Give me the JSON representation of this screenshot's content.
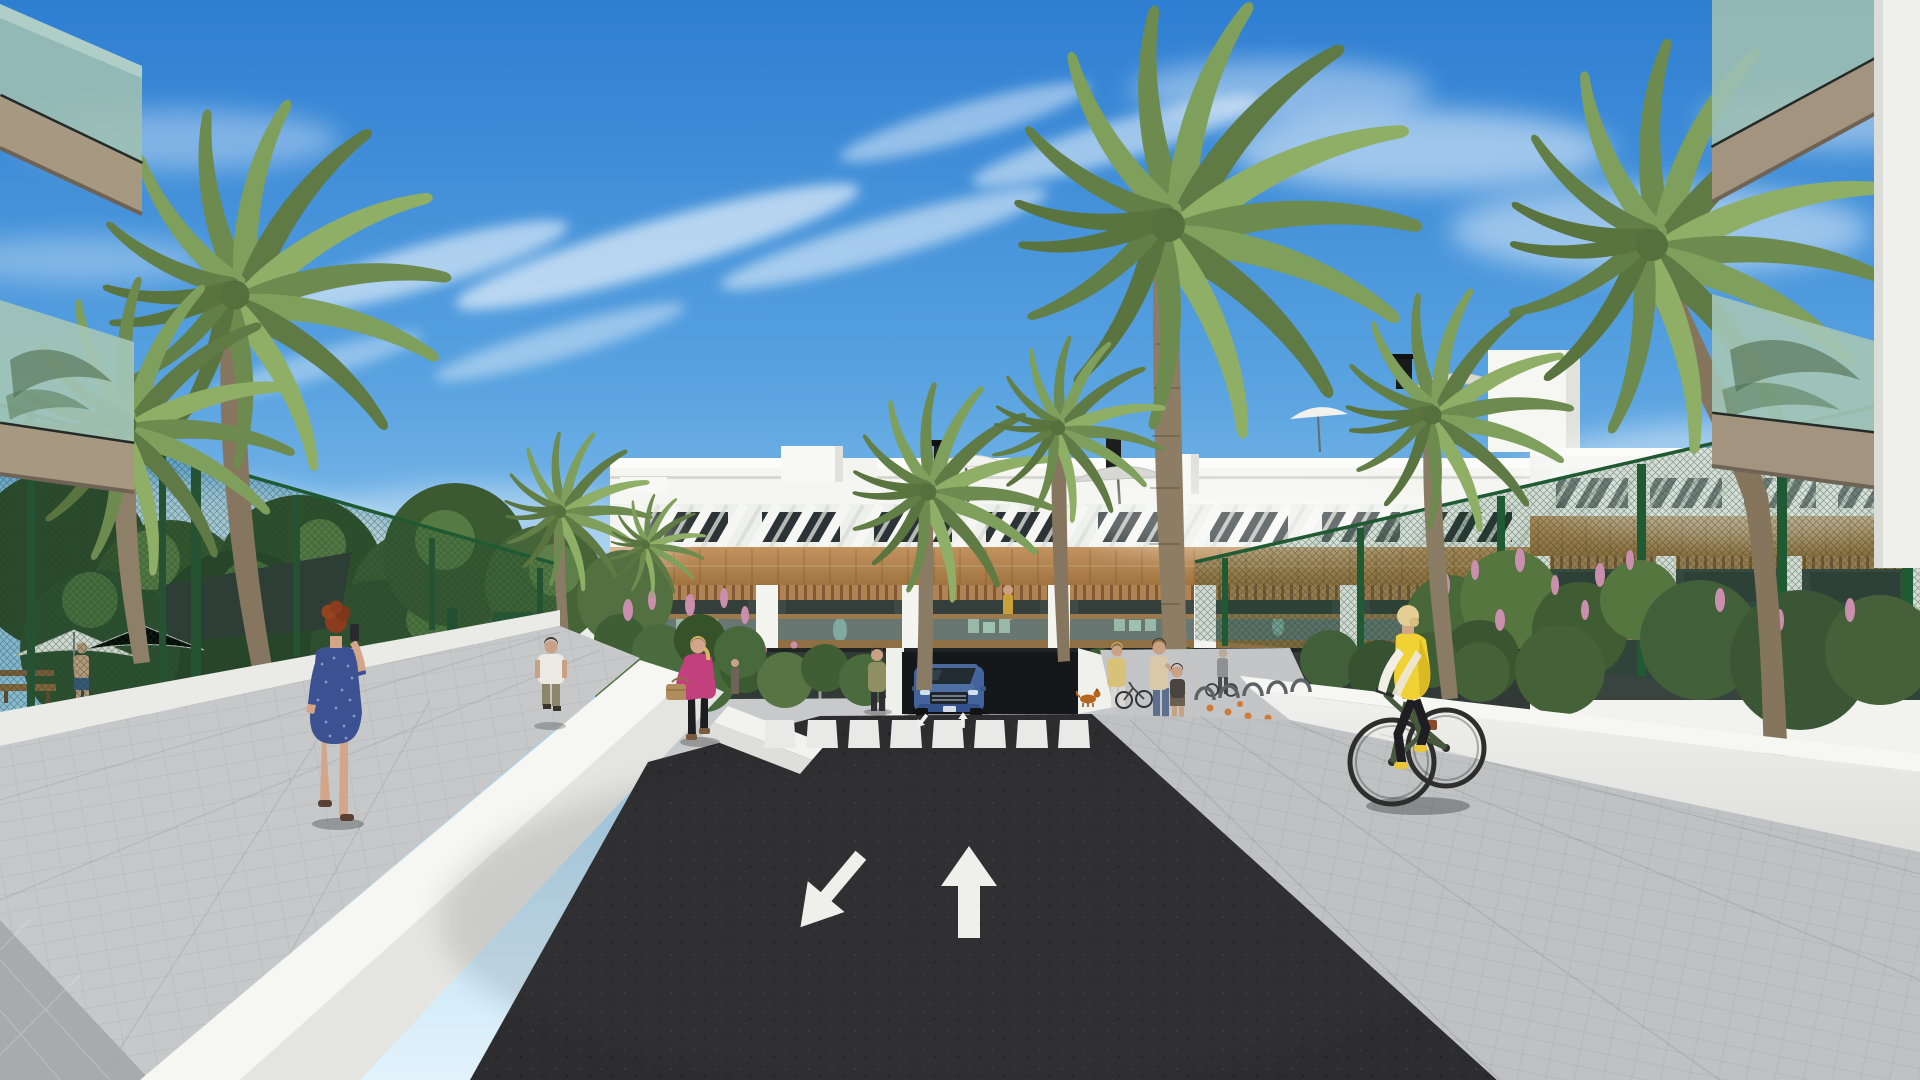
{
  "scene": {
    "title": "Residential complex exterior – architectural 3D render",
    "type": "3d-architectural-visualization",
    "time_of_day": "sunny daytime",
    "description": "Street-level view of a modern white Mediterranean apartment complex: entry drive of dark asphalt with painted lane arrows and a zebra crossing leading to an underground garage, flanked by palm trees, green mesh fences, white garden walls, pedestrians and a cyclist."
  },
  "palette": {
    "sky_top": "#2e7ed2",
    "sky_horizon": "#e2f2fb",
    "cloud": "#ffffff",
    "facade_white": "#f5f5f2",
    "window_dark": "#2b3336",
    "wood_cladding": "#b5895d",
    "pergola_wood": "#b08354",
    "balcony_glass": "#9dbfb2",
    "balcony_fascia": "#a69881",
    "fence_green": "#1f5a33",
    "foliage_dark": "#3c5a31",
    "palm_frond": "#7fa05c",
    "palm_trunk": "#8d7d64",
    "asphalt": "#2d2c2e",
    "road_marking": "#efefec",
    "sidewalk": "#c6c7c9",
    "wall_white": "#f6f6f3",
    "car_blue": "#4d6ea6",
    "dress_blue": "#3b5192",
    "jacket_pink": "#c2407c",
    "vest_yellow": "#f0d235",
    "flower_pink": "#c98fac",
    "flower_orange": "#d07a36"
  },
  "regions": {
    "sky": "Blue sky with wispy cirrus clouds",
    "center_building": "Three-storey white apartment block with rooftop terraces, slatted pergolas, wood cladding and recessed balconies",
    "right_building": "Matching white apartment block on the right with wood balcony band",
    "foreground_balconies": "Near cantilevered balconies with green glass balustrades framing the view",
    "left_amenity": "Fenced pool garden with parasols, shade sail and bench",
    "gardens": "Hedges and flowering shrubs along the buildings",
    "palms": "Tall palm trees lining the drive",
    "road": "Dark asphalt entry drive",
    "garage": "Underground car-park ramp entrance",
    "left_sidewalk": "Light paver walkway on the left",
    "right_sidewalk": "Light paver walkway on the right"
  },
  "road": {
    "markings": [
      "Straight-ahead lane arrow",
      "Diagonal exit lane arrow",
      "Zebra pedestrian crossing",
      "Small ramp direction arrows"
    ]
  },
  "people": [
    {
      "label": "Red-haired woman in patterned blue dress talking on phone",
      "color": "#3b5192"
    },
    {
      "label": "Man in white t-shirt walking on the left path",
      "color": "#eceae2"
    },
    {
      "label": "Blonde woman in pink jacket with handbag",
      "color": "#c2407c"
    },
    {
      "label": "Woman standing near the garage ramp",
      "color": "#8f8f63"
    },
    {
      "label": "Mother with child near the entrance walkway",
      "color": "#d9c9a8"
    },
    {
      "label": "Woman at the bicycle racks",
      "color": "#d8c27a"
    },
    {
      "label": "Person wheeling a bicycle",
      "color": "#8f9094"
    },
    {
      "label": "Cyclist in yellow vest on green bicycle",
      "color": "#f0d235"
    },
    {
      "label": "Shirtless man by the pool garden",
      "color": "#cfa687"
    },
    {
      "label": "Couple standing on right building balcony",
      "color": "#3f7d6e"
    },
    {
      "label": "Resident in mustard dress on center balcony",
      "color": "#c9a13b"
    }
  ],
  "vehicles": [
    {
      "label": "Blue SUV at the garage ramp",
      "color": "#4d6ea6"
    },
    {
      "label": "Dark green city bicycle",
      "color": "#47593c"
    },
    {
      "label": "Parked bicycle at the racks",
      "color": "#30343a"
    }
  ],
  "animals": [
    {
      "label": "Small brown dog",
      "color": "#b5651d"
    }
  ]
}
